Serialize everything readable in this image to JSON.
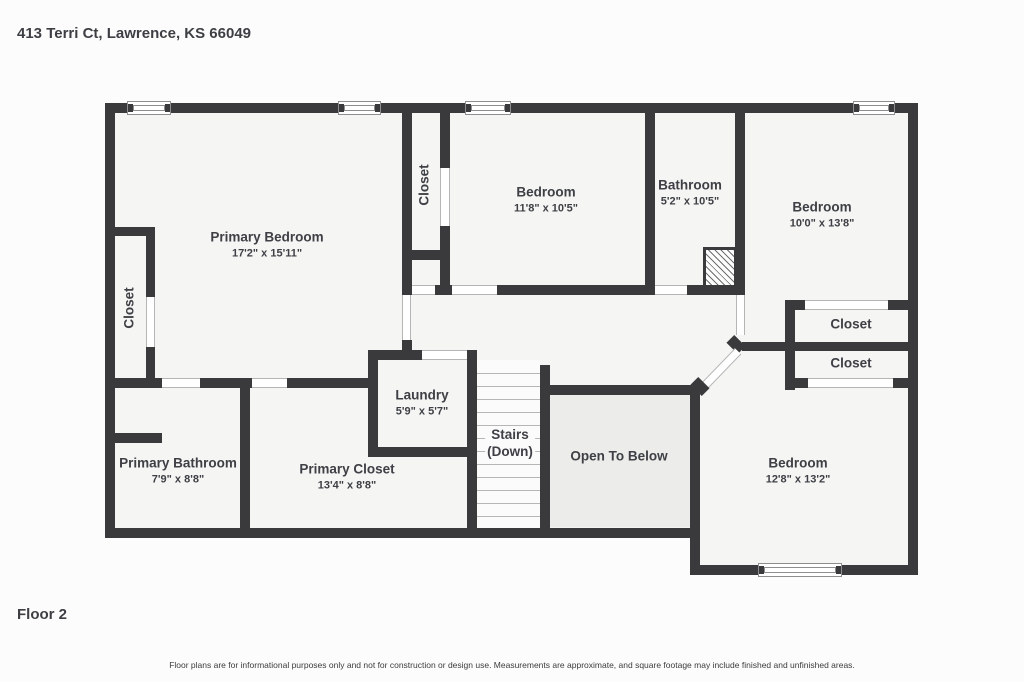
{
  "header": {
    "address": "413 Terri Ct, Lawrence, KS 66049"
  },
  "floor": {
    "label": "Floor 2"
  },
  "footer": {
    "disclaimer": "Floor plans are for informational purposes only and not for construction or design use. Measurements are approximate, and square footage may include finished and unfinished areas."
  },
  "palette": {
    "wall": "#3a3a3c",
    "room_fill": "#f5f5f4",
    "open_to_below_fill": "#ececea",
    "stairs_fill": "#fbfbfb",
    "text": "#3e4045"
  },
  "rooms": {
    "primary_bedroom": {
      "name": "Primary Bedroom",
      "dims": "17'2\" x 15'11\""
    },
    "bedroom_top": {
      "name": "Bedroom",
      "dims": "11'8\" x 10'5\""
    },
    "bathroom": {
      "name": "Bathroom",
      "dims": "5'2\" x 10'5\""
    },
    "bedroom_right": {
      "name": "Bedroom",
      "dims": "10'0\" x 13'8\""
    },
    "bedroom_bottom": {
      "name": "Bedroom",
      "dims": "12'8\" x 13'2\""
    },
    "primary_bathroom": {
      "name": "Primary Bathroom",
      "dims": "7'9\" x 8'8\""
    },
    "primary_closet": {
      "name": "Primary Closet",
      "dims": "13'4\" x 8'8\""
    },
    "laundry": {
      "name": "Laundry",
      "dims": "5'9\" x 5'7\""
    },
    "stairs": {
      "name": "Stairs",
      "sub": "(Down)"
    },
    "open_to_below": {
      "name": "Open To Below"
    },
    "closet_left": {
      "name": "Closet"
    },
    "closet_top": {
      "name": "Closet"
    },
    "closet_right_1": {
      "name": "Closet"
    },
    "closet_right_2": {
      "name": "Closet"
    }
  }
}
